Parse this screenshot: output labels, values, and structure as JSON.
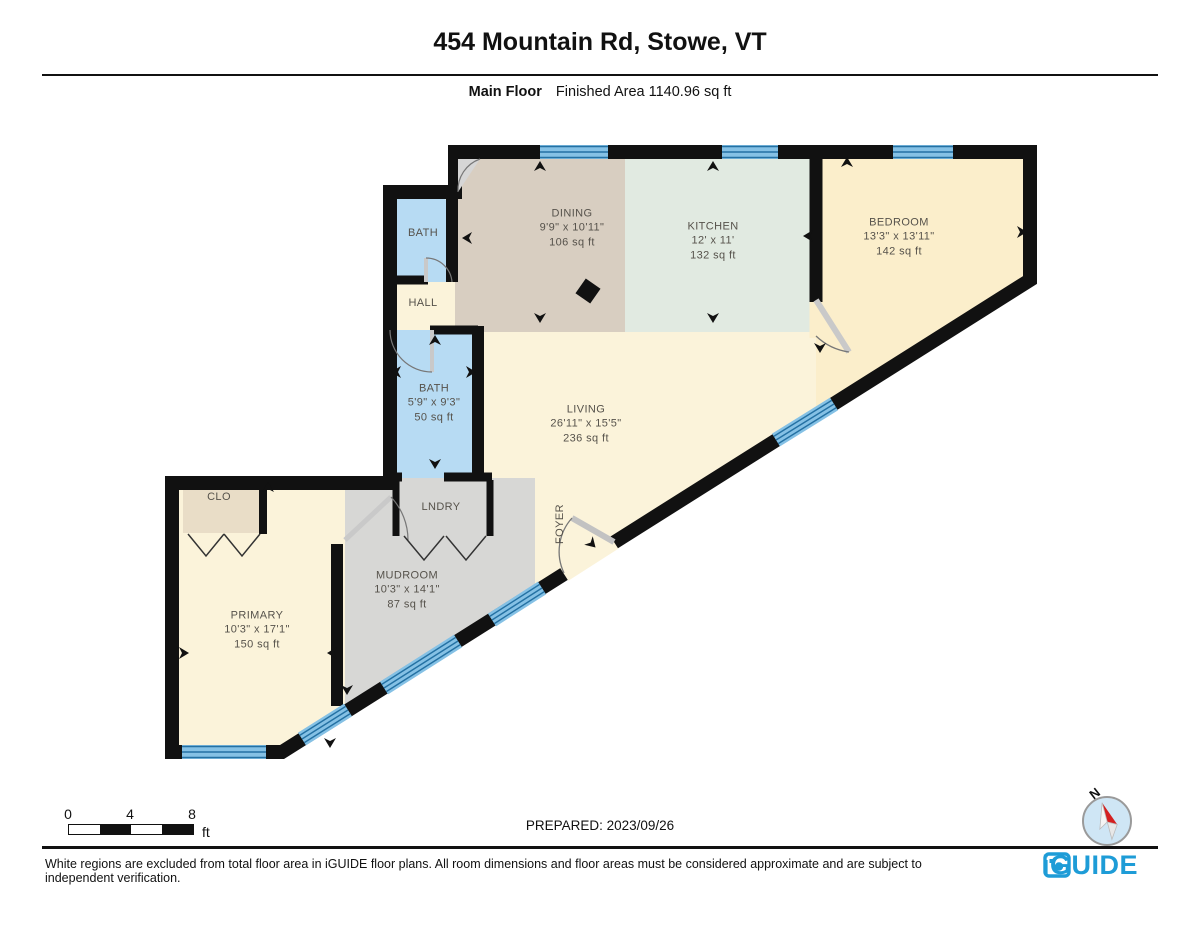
{
  "header": {
    "title": "454 Mountain Rd, Stowe, VT",
    "floor_label": "Main Floor",
    "finished_area": "Finished Area 1140.96 sq ft"
  },
  "rooms": [
    {
      "name": "BATH"
    },
    {
      "name": "HALL"
    },
    {
      "name": "DINING",
      "dims": "9'9\" x 10'11\"",
      "area": "106 sq ft"
    },
    {
      "name": "KITCHEN",
      "dims": "12' x 11'",
      "area": "132 sq ft"
    },
    {
      "name": "BEDROOM",
      "dims": "13'3\" x 13'11\"",
      "area": "142 sq ft"
    },
    {
      "name": "BATH",
      "dims": "5'9\" x 9'3\"",
      "area": "50 sq ft"
    },
    {
      "name": "LIVING",
      "dims": "26'11\" x 15'5\"",
      "area": "236 sq ft"
    },
    {
      "name": "CLO"
    },
    {
      "name": "LNDRY"
    },
    {
      "name": "FOYER"
    },
    {
      "name": "MUDROOM",
      "dims": "10'3\" x 14'1\"",
      "area": "87 sq ft"
    },
    {
      "name": "PRIMARY",
      "dims": "10'3\" x 17'1\"",
      "area": "150 sq ft"
    }
  ],
  "scale_bar": {
    "ticks": [
      "0",
      "4",
      "8"
    ],
    "unit": "ft"
  },
  "prepared": "PREPARED: 2023/09/26",
  "compass": {
    "label": "N"
  },
  "footer": {
    "disclaimer": "White regions are excluded from total floor area in iGUIDE floor plans. All room dimensions and floor areas must be considered approximate and are subject to independent verification.",
    "brand": "iGUIDE"
  },
  "colors": {
    "wall": "#111111",
    "window_blue": "#85c1e5",
    "brand_blue": "#1e9cd7",
    "living_cream": "#fbf3da",
    "bedroom_cream": "#fbeecb",
    "dining_tan": "#d8cec1",
    "kitchen_green": "#e1eae1",
    "bath_blue": "#b7dbf3",
    "closet_beige": "#e9ddc7",
    "mudroom_gray": "#d7d7d5"
  }
}
